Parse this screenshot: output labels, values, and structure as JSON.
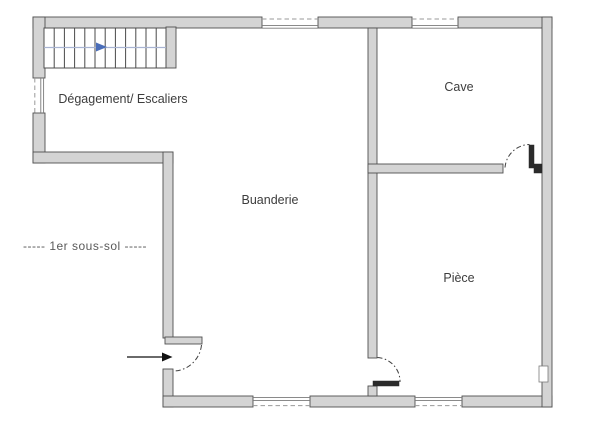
{
  "floor_plan": {
    "level_label": "----- 1er sous-sol -----",
    "rooms": [
      {
        "label": "Dégagement/ Escaliers"
      },
      {
        "label": "Cave"
      },
      {
        "label": "Buanderie"
      },
      {
        "label": "Pièce"
      }
    ],
    "icons": {
      "stairs_direction": "right-arrow",
      "entrance_direction": "right-arrow"
    },
    "colors": {
      "wall_fill": "#d4d4d4",
      "wall_edge": "#4f4f4f",
      "stair_arrow_blue": "#4a6db8",
      "entrance_arrow_black": "#111111",
      "room_label_text": "#3d3d3d",
      "level_label_text": "#5a5a5a"
    }
  }
}
